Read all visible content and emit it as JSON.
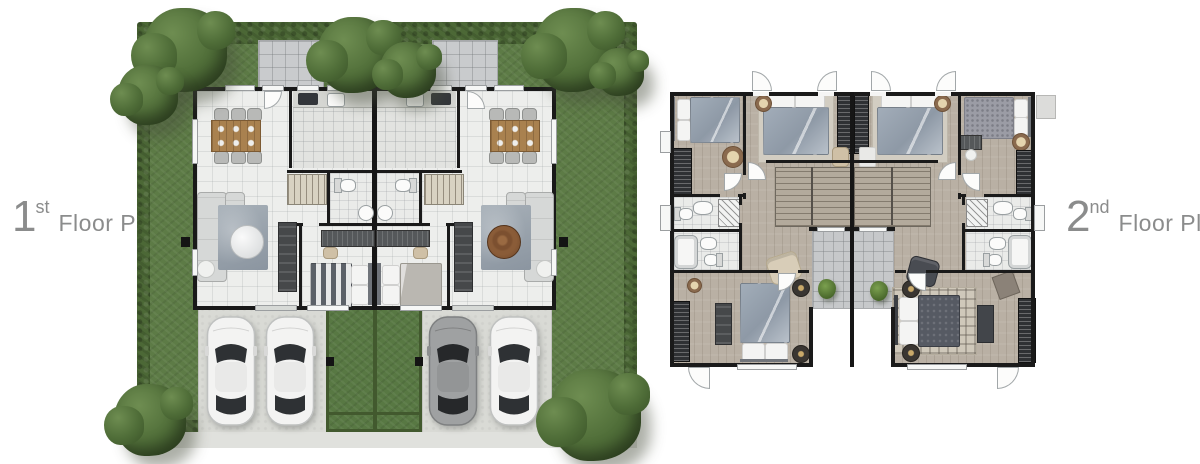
{
  "labels": {
    "first": {
      "number": "1",
      "ordinal": "st",
      "caption": "Floor Plan"
    },
    "second": {
      "number": "2",
      "ordinal": "nd",
      "caption": "Floor Plan"
    }
  },
  "palette": {
    "label_text": "#8b8c8c",
    "hedge_dark": "#4c6836",
    "lawn": "#5d7b46",
    "wall": "#1a1a1a",
    "tile_floor": "#edeeec",
    "wood_floor": "#b9b0a4",
    "balcony_tile": "#c6c8ca",
    "driveway": "#d9dad5",
    "sidewalk": "#e0e1dd",
    "wood_table": "#a9814f",
    "bed_blue_gray": "#98a3af",
    "car_white": "#f3f3f2",
    "car_gray": "#9fa1a2"
  },
  "first_floor_plan": {
    "name": "1st floor site plan",
    "layout": "mirrored twin house",
    "units": 2,
    "cars": 4,
    "trees": 8,
    "dining_chairs_per_unit": 6,
    "features": [
      "garden hedge border",
      "corner trees",
      "back patios",
      "dining area",
      "kitchen with cooktop and sink",
      "staircase",
      "bathroom",
      "living room with sofa and rug",
      "bedroom",
      "two-car driveway per unit",
      "central lawn",
      "front sidewalk"
    ]
  },
  "second_floor_plan": {
    "name": "2nd floor plan",
    "layout": "mirrored twin house",
    "units": 2,
    "bedrooms_per_unit": 3,
    "bathrooms_per_unit": 2,
    "features": [
      "wood flooring",
      "stair hall",
      "central balconies with plants",
      "wardrobes",
      "master bedroom",
      "door swing arcs"
    ]
  }
}
